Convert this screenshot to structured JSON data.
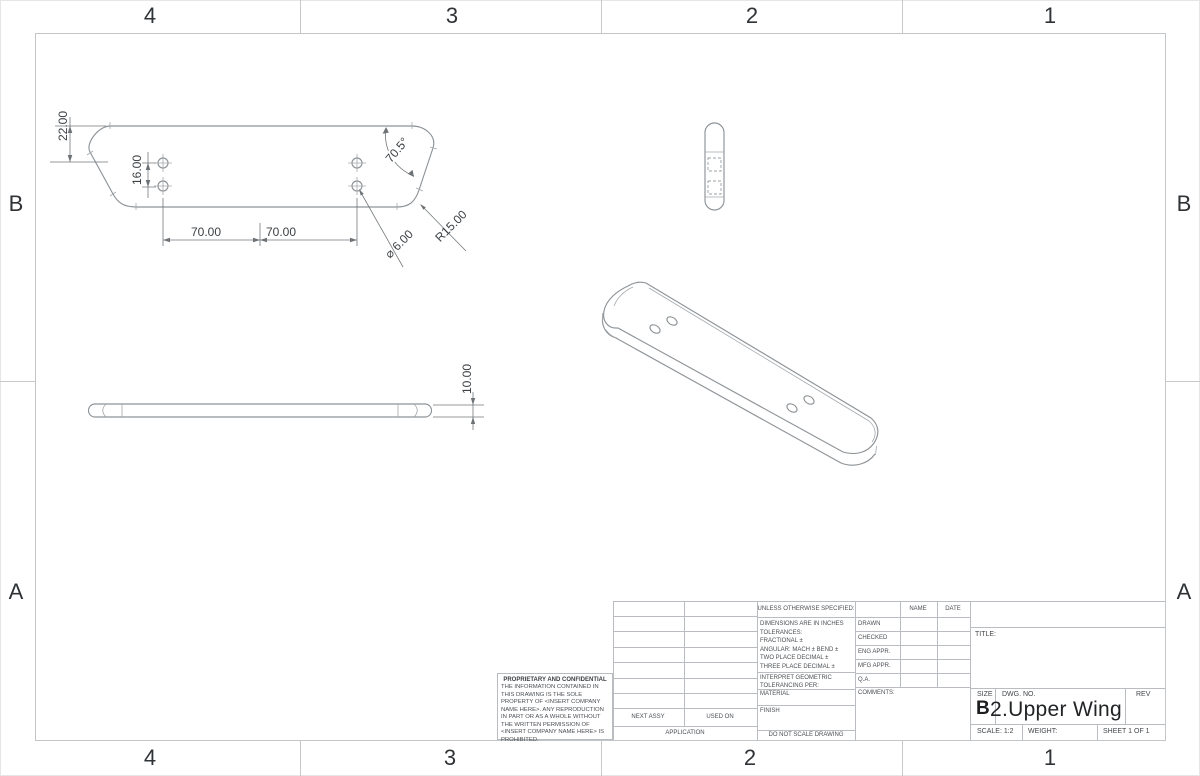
{
  "zones": {
    "top": [
      "4",
      "3",
      "2",
      "1"
    ],
    "bottom": [
      "4",
      "3",
      "2",
      "1"
    ],
    "left": [
      "B",
      "A"
    ],
    "right": [
      "B",
      "A"
    ]
  },
  "drawing": {
    "dims": {
      "edge_offset": "22.00",
      "hole_row_spacing": "16.00",
      "hole_span_left": "70.00",
      "hole_span_right": "70.00",
      "corner_angle": "70.5°",
      "corner_radius": "R15.00",
      "hole_diameter": "⌀ 6.00",
      "thickness": "10.00"
    }
  },
  "title_block": {
    "proprietary": {
      "heading": "PROPRIETARY AND CONFIDENTIAL",
      "body": "THE INFORMATION CONTAINED IN THIS DRAWING IS THE SOLE PROPERTY OF <INSERT COMPANY NAME HERE>.  ANY REPRODUCTION IN PART OR AS A WHOLE WITHOUT THE WRITTEN PERMISSION OF <INSERT COMPANY NAME HERE> IS PROHIBITED."
    },
    "application": {
      "next_assy": "NEXT ASSY",
      "used_on": "USED ON",
      "label": "APPLICATION"
    },
    "specs": {
      "unless": "UNLESS OTHERWISE SPECIFIED:",
      "lines": [
        "DIMENSIONS ARE IN INCHES",
        "TOLERANCES:",
        "FRACTIONAL ±",
        "ANGULAR: MACH ±   BEND ±",
        "TWO PLACE DECIMAL    ±",
        "THREE PLACE DECIMAL  ±"
      ],
      "interpret": "INTERPRET GEOMETRIC TOLERANCING PER:",
      "material": "MATERIAL",
      "finish": "FINISH",
      "do_not_scale": "DO NOT SCALE DRAWING"
    },
    "approvals": {
      "name_header": "NAME",
      "date_header": "DATE",
      "rows": [
        "DRAWN",
        "CHECKED",
        "ENG APPR.",
        "MFG APPR.",
        "Q.A."
      ],
      "comments": "COMMENTS:"
    },
    "title_area": {
      "title_label": "TITLE:",
      "size_label": "SIZE",
      "size_value": "B",
      "dwg_label": "DWG.  NO.",
      "dwg_value": "2.Upper Wing",
      "rev_label": "REV",
      "scale": "SCALE: 1:2",
      "weight": "WEIGHT:",
      "sheet": "SHEET 1 OF 1"
    }
  }
}
